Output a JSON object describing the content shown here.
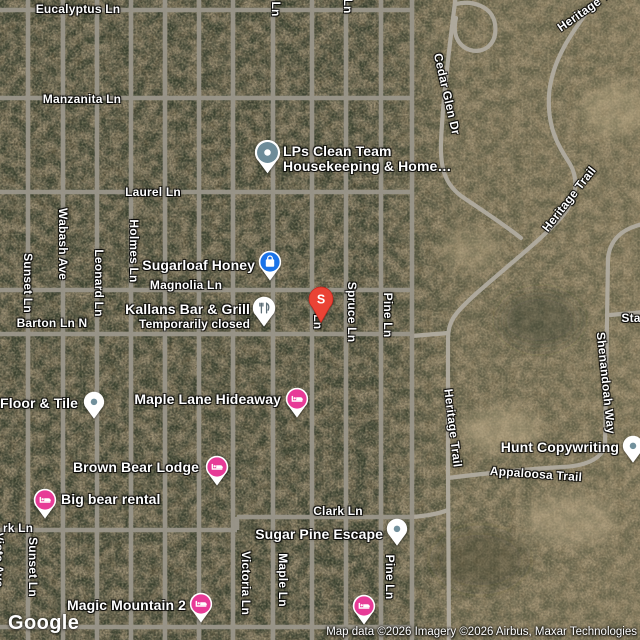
{
  "map": {
    "provider": "Google",
    "attribution": "Map data ©2026 Imagery ©2026 Airbus, Maxar Technologies",
    "colors": {
      "terrain_base": "#8c8168",
      "terrain_trees": "#3c4433",
      "road_grid": "#9a958a",
      "road_rural": "#aFaa9e",
      "pin_lodging": "#e73b97",
      "pin_store_blue": "#1a73e8",
      "pin_generic_dot": "#6e8c99",
      "pin_search_red": "#ea4335",
      "label_text": "#ffffff"
    },
    "street_labels": [
      {
        "text": "Eucalyptus Ln"
      },
      {
        "text": "Manzanita Ln"
      },
      {
        "text": "Laurel Ln"
      },
      {
        "text": "Magnolia Ln"
      },
      {
        "text": "Barton Ln N"
      },
      {
        "text": "Clark Ln"
      },
      {
        "text": "rk Ln"
      },
      {
        "text": "Sunset Ln"
      },
      {
        "text": "Wabash Ave"
      },
      {
        "text": "Leonard Ln"
      },
      {
        "text": "Holmes Ln"
      },
      {
        "text": "Fir Ln"
      },
      {
        "text": "Spruce Ln"
      },
      {
        "text": "Pine Ln"
      },
      {
        "text": "Victoria Ln"
      },
      {
        "text": "Maple Ln"
      },
      {
        "text": "Pine Ln"
      },
      {
        "text": "Sunset Ln"
      },
      {
        "text": "Vista Ave"
      },
      {
        "text": "Ln"
      },
      {
        "text": "Ln"
      },
      {
        "text": "Cedar Glen Dr"
      },
      {
        "text": "Heritage Trail"
      },
      {
        "text": "Heritage Trail"
      },
      {
        "text": "Heritage Trail"
      },
      {
        "text": "Shenandoah Way"
      },
      {
        "text": "Sta"
      },
      {
        "text": "Appaloosa Trail"
      }
    ],
    "pois": [
      {
        "line1": "LPs Clean Team",
        "line2": "Housekeeping & Home…",
        "pin": "generic-large"
      },
      {
        "line1": "Sugarloaf Honey",
        "pin": "store"
      },
      {
        "line1": "Kallans Bar & Grill",
        "line2": "Temporarily closed",
        "pin": "restaurant-closed"
      },
      {
        "letter": "S",
        "pin": "search-red"
      },
      {
        "line1": "s Floor & Tile",
        "pin": "generic"
      },
      {
        "line1": "Maple Lane Hideaway",
        "pin": "lodging"
      },
      {
        "line1": "Brown Bear Lodge",
        "pin": "lodging"
      },
      {
        "line1": "Big bear rental",
        "pin": "lodging"
      },
      {
        "line1": "Magic Mountain 2",
        "pin": "lodging"
      },
      {
        "pin": "lodging"
      },
      {
        "line1": "Sugar Pine Escape",
        "pin": "generic"
      },
      {
        "line1": "Hunt Copywriting",
        "pin": "generic"
      }
    ]
  }
}
